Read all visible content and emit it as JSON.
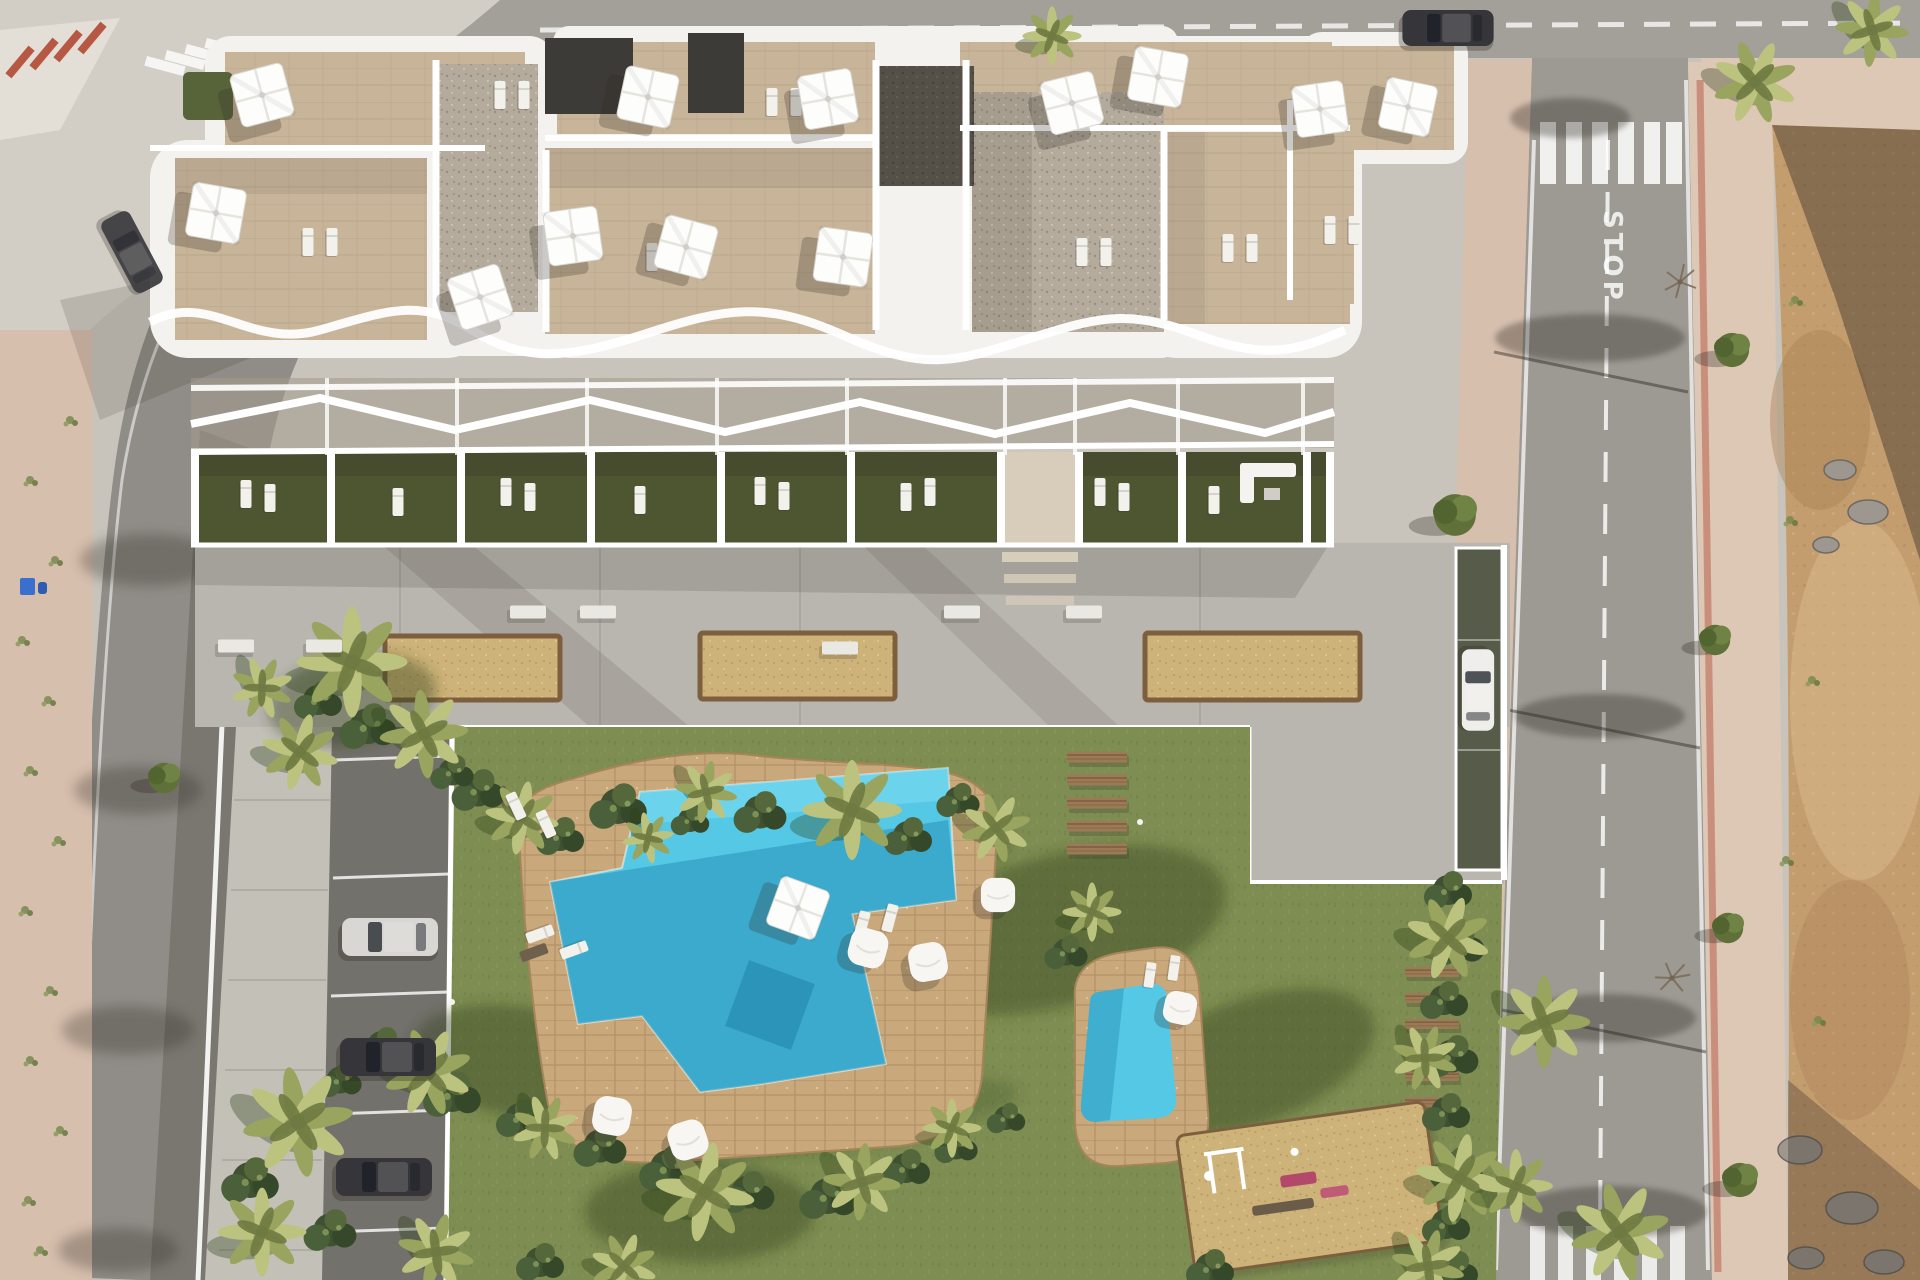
{
  "road": {
    "stop_marking": "STOP"
  },
  "palette": {
    "pavement": "#c8c4bb",
    "pavement2": "#d2cec5",
    "roadTop": "#a3a099",
    "roadRight": "#9d9a93",
    "sidewalkPink": "#d7bfae",
    "sidewalkPink2": "#ddc7b5",
    "curbRed": "#b75844",
    "parkingAsphalt": "#73716b",
    "walkway": "#c3c0b8",
    "concreteDeck": "#b9b6af",
    "white": "#ffffff",
    "buildingWhite": "#f3f2ee",
    "tanTile": "#c7b499",
    "tanTileLine": "#b1a084",
    "gravelLight": "#b4ab9c",
    "gravelDot": "#978e7f",
    "gravelDark": "#545048",
    "pergolaDark": "#3d3b37",
    "gardenGreen": "#4d5531",
    "lawn": "#7e8d52",
    "lawnShadow": "#2c4218",
    "plantDark": "#3f5130",
    "palmLight": "#bcc37f",
    "palmMid": "#99a45e",
    "palmDark": "#6e7a41",
    "poolDeck": "#c9a97b",
    "poolAqua": "#55c8e6",
    "poolAquaLight": "#7cdaf0",
    "poolDeep": "#1d86ac",
    "sand": "#cdb379",
    "sandRim": "#7d5f3e",
    "plank": "#9b7a56",
    "plankDark": "#76553a",
    "dirt": "#c49d6f",
    "dirtDark": "#a87f52",
    "dirtLight": "#d9bb8b",
    "rock": "#9d9790",
    "shadow": "#2e2922",
    "carSilver": "#d8d7d3",
    "carDark": "#36363a",
    "carWhite": "#efeeeb",
    "binBlue": "#3a6fd0",
    "rampGreen": "#575c4a",
    "equipPink": "#b2486a",
    "benchWhite": "#e9e8e3",
    "stepTan": "#d8cdbb"
  },
  "scene": {
    "palms": [
      [
        352,
        662,
        1.5,
        0
      ],
      [
        424,
        734,
        1.2,
        40
      ],
      [
        300,
        752,
        1.05,
        15
      ],
      [
        262,
        688,
        0.85,
        70
      ],
      [
        522,
        818,
        1.0,
        10
      ],
      [
        706,
        792,
        0.85,
        55
      ],
      [
        852,
        810,
        1.35,
        0
      ],
      [
        996,
        828,
        0.95,
        30
      ],
      [
        648,
        838,
        0.7,
        80
      ],
      [
        1448,
        938,
        1.15,
        20
      ],
      [
        1425,
        1058,
        0.9,
        65
      ],
      [
        1460,
        1178,
        1.2,
        10
      ],
      [
        1544,
        1022,
        1.25,
        45
      ],
      [
        1516,
        1186,
        1.0,
        0
      ],
      [
        1620,
        1232,
        1.35,
        30
      ],
      [
        1428,
        1266,
        1.0,
        60
      ],
      [
        428,
        1072,
        1.2,
        25
      ],
      [
        545,
        1128,
        0.9,
        70
      ],
      [
        705,
        1192,
        1.35,
        10
      ],
      [
        862,
        1182,
        1.05,
        50
      ],
      [
        952,
        1128,
        0.8,
        0
      ],
      [
        298,
        1122,
        1.5,
        35
      ],
      [
        262,
        1232,
        1.2,
        0
      ],
      [
        436,
        1252,
        1.05,
        60
      ],
      [
        624,
        1266,
        0.9,
        20
      ],
      [
        1052,
        36,
        0.8,
        0
      ],
      [
        1755,
        82,
        1.15,
        25
      ],
      [
        1872,
        30,
        1.0,
        50
      ],
      [
        1092,
        912,
        0.8,
        0
      ]
    ],
    "bushes": [
      [
        478,
        790,
        1.1
      ],
      [
        560,
        836,
        1.0
      ],
      [
        618,
        806,
        1.2
      ],
      [
        760,
        812,
        1.1
      ],
      [
        908,
        836,
        1.0
      ],
      [
        958,
        800,
        0.9
      ],
      [
        690,
        820,
        0.8
      ],
      [
        368,
        726,
        1.2
      ],
      [
        318,
        700,
        1.0
      ],
      [
        452,
        772,
        0.9
      ],
      [
        1448,
        890,
        1.0
      ],
      [
        1458,
        944,
        1.1
      ],
      [
        1444,
        1000,
        1.0
      ],
      [
        1452,
        1056,
        1.1
      ],
      [
        1446,
        1112,
        1.0
      ],
      [
        1456,
        1168,
        1.1
      ],
      [
        1446,
        1224,
        1.0
      ],
      [
        1454,
        1270,
        1.0
      ],
      [
        382,
        1046,
        1.0
      ],
      [
        452,
        1094,
        1.2
      ],
      [
        520,
        1118,
        1.0
      ],
      [
        600,
        1146,
        1.1
      ],
      [
        668,
        1168,
        1.2
      ],
      [
        748,
        1192,
        1.1
      ],
      [
        828,
        1196,
        1.2
      ],
      [
        906,
        1168,
        1.0
      ],
      [
        956,
        1146,
        0.9
      ],
      [
        1006,
        1118,
        0.8
      ],
      [
        340,
        1080,
        0.9
      ],
      [
        250,
        1180,
        1.2
      ],
      [
        330,
        1230,
        1.1
      ],
      [
        540,
        1262,
        1.0
      ],
      [
        1066,
        952,
        0.9
      ],
      [
        1210,
        1268,
        1.0
      ]
    ],
    "umbrellas": [
      [
        262,
        95,
        1,
        -15
      ],
      [
        216,
        213,
        1,
        10
      ],
      [
        480,
        297,
        1,
        -18
      ],
      [
        648,
        97,
        1,
        12
      ],
      [
        573,
        236,
        1,
        -8
      ],
      [
        686,
        247,
        1,
        15
      ],
      [
        828,
        99,
        1,
        -10
      ],
      [
        843,
        257,
        1,
        8
      ],
      [
        1072,
        103,
        1,
        -14
      ],
      [
        1158,
        77,
        1,
        10
      ],
      [
        1320,
        109,
        0.95,
        -8
      ],
      [
        1408,
        107,
        0.95,
        12
      ],
      [
        798,
        908,
        0.95,
        20
      ]
    ],
    "beanbags": [
      [
        868,
        948,
        1,
        15
      ],
      [
        928,
        962,
        1,
        -10
      ],
      [
        612,
        1116,
        1,
        10
      ],
      [
        688,
        1140,
        1,
        -18
      ],
      [
        998,
        895,
        0.9,
        0
      ],
      [
        1180,
        1008,
        0.85,
        12
      ]
    ],
    "roof_loungers": [
      [
        308,
        242
      ],
      [
        332,
        242
      ],
      [
        500,
        95
      ],
      [
        524,
        95
      ],
      [
        772,
        102
      ],
      [
        796,
        102
      ],
      [
        1082,
        252
      ],
      [
        1106,
        252
      ],
      [
        1228,
        248
      ],
      [
        1252,
        248
      ],
      [
        652,
        257
      ],
      [
        676,
        257
      ],
      [
        1330,
        230
      ],
      [
        1354,
        230
      ]
    ],
    "garden_loungers": [
      [
        246,
        494
      ],
      [
        270,
        498
      ],
      [
        398,
        502
      ],
      [
        506,
        492
      ],
      [
        530,
        497
      ],
      [
        640,
        500
      ],
      [
        760,
        491
      ],
      [
        784,
        496
      ],
      [
        906,
        497
      ],
      [
        930,
        492
      ],
      [
        1100,
        492
      ],
      [
        1124,
        497
      ],
      [
        1214,
        500
      ]
    ],
    "pool_loungers": [
      [
        516,
        806,
        1,
        -25
      ],
      [
        546,
        824,
        1,
        -25
      ],
      [
        540,
        934,
        1,
        70
      ],
      [
        574,
        950,
        1,
        70
      ],
      [
        862,
        925,
        1,
        15
      ],
      [
        890,
        918,
        1,
        15
      ],
      [
        1150,
        975,
        0.9,
        8
      ],
      [
        1174,
        968,
        0.9,
        8
      ]
    ],
    "benches": [
      [
        236,
        646
      ],
      [
        324,
        646
      ],
      [
        528,
        612
      ],
      [
        598,
        612
      ],
      [
        962,
        612
      ],
      [
        1084,
        612
      ],
      [
        840,
        648
      ]
    ],
    "planks_a": [
      [
        1097,
        757
      ],
      [
        1097,
        780
      ],
      [
        1097,
        803
      ],
      [
        1097,
        826
      ],
      [
        1097,
        849
      ]
    ],
    "planks_b": [
      [
        1432,
        972,
        0.9
      ],
      [
        1432,
        998,
        0.9
      ],
      [
        1432,
        1024,
        0.9
      ],
      [
        1432,
        1050,
        0.9
      ],
      [
        1432,
        1076,
        0.9
      ],
      [
        1432,
        1102,
        0.9
      ]
    ],
    "weeds": [
      [
        30,
        480
      ],
      [
        55,
        560
      ],
      [
        22,
        640
      ],
      [
        48,
        700
      ],
      [
        30,
        770
      ],
      [
        58,
        840
      ],
      [
        25,
        910
      ],
      [
        50,
        990
      ],
      [
        30,
        1060
      ],
      [
        60,
        1130
      ],
      [
        28,
        1200
      ],
      [
        1790,
        520
      ],
      [
        1812,
        680
      ],
      [
        1786,
        860
      ],
      [
        1818,
        1020
      ],
      [
        1795,
        300
      ],
      [
        70,
        420
      ],
      [
        40,
        1250
      ]
    ],
    "trees": [
      [
        1455,
        515,
        1.1
      ],
      [
        164,
        778,
        0.8
      ],
      [
        1732,
        350,
        0.9
      ],
      [
        1715,
        640,
        0.8
      ],
      [
        1728,
        928,
        0.8
      ],
      [
        1740,
        1180,
        0.9
      ]
    ],
    "bare_trees": [
      [
        1680,
        282,
        1,
        0
      ],
      [
        1672,
        978,
        1,
        30
      ]
    ]
  }
}
